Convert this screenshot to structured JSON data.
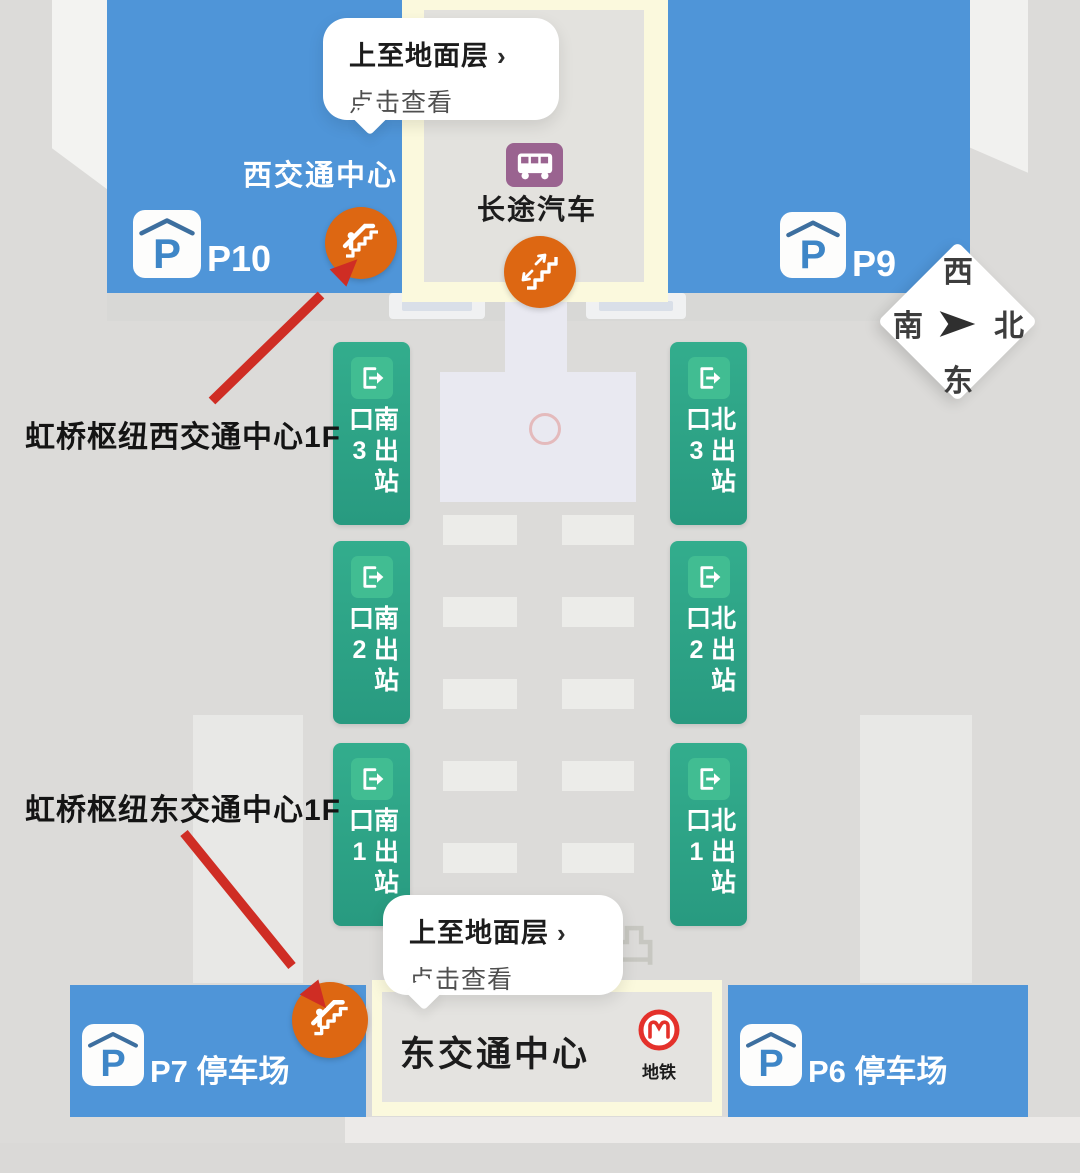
{
  "tooltips": {
    "top": {
      "action": "上至地面层",
      "chevron": "›",
      "hint": "点击查看"
    },
    "bottom": {
      "action": "上至地面层",
      "chevron": "›",
      "hint": "点击查看"
    }
  },
  "blocks": {
    "west_center": {
      "name": "西交通中心",
      "parking_id": "P10"
    },
    "east_top": {
      "parking_id": "P9"
    },
    "bus": {
      "label": "长途汽车"
    },
    "p7": {
      "label": "P7 停车场"
    },
    "p6": {
      "label": "P6 停车场"
    },
    "east_center": {
      "name": "东交通中心",
      "metro_label": "地铁"
    }
  },
  "parking_symbol": "P",
  "exits": {
    "south": [
      "南出站口3",
      "南出站口2",
      "南出站口1"
    ],
    "north": [
      "北出站口3",
      "北出站口2",
      "北出站口1"
    ]
  },
  "annotations": {
    "west": "虹桥枢纽西交通中心1F",
    "east": "虹桥枢纽东交通中心1F"
  },
  "compass": {
    "top": "西",
    "left": "南",
    "right": "北",
    "bottom": "东"
  },
  "ghost_glyph": "凸",
  "colors": {
    "block_blue": "#4f95d8",
    "exit_green": "#2da289",
    "marker_orange": "#dd6712",
    "arrow_red": "#cf2d24",
    "metro_red": "#e4312b",
    "bus_plum": "#9a6390",
    "panel_yellow": "#fbf9dd"
  }
}
